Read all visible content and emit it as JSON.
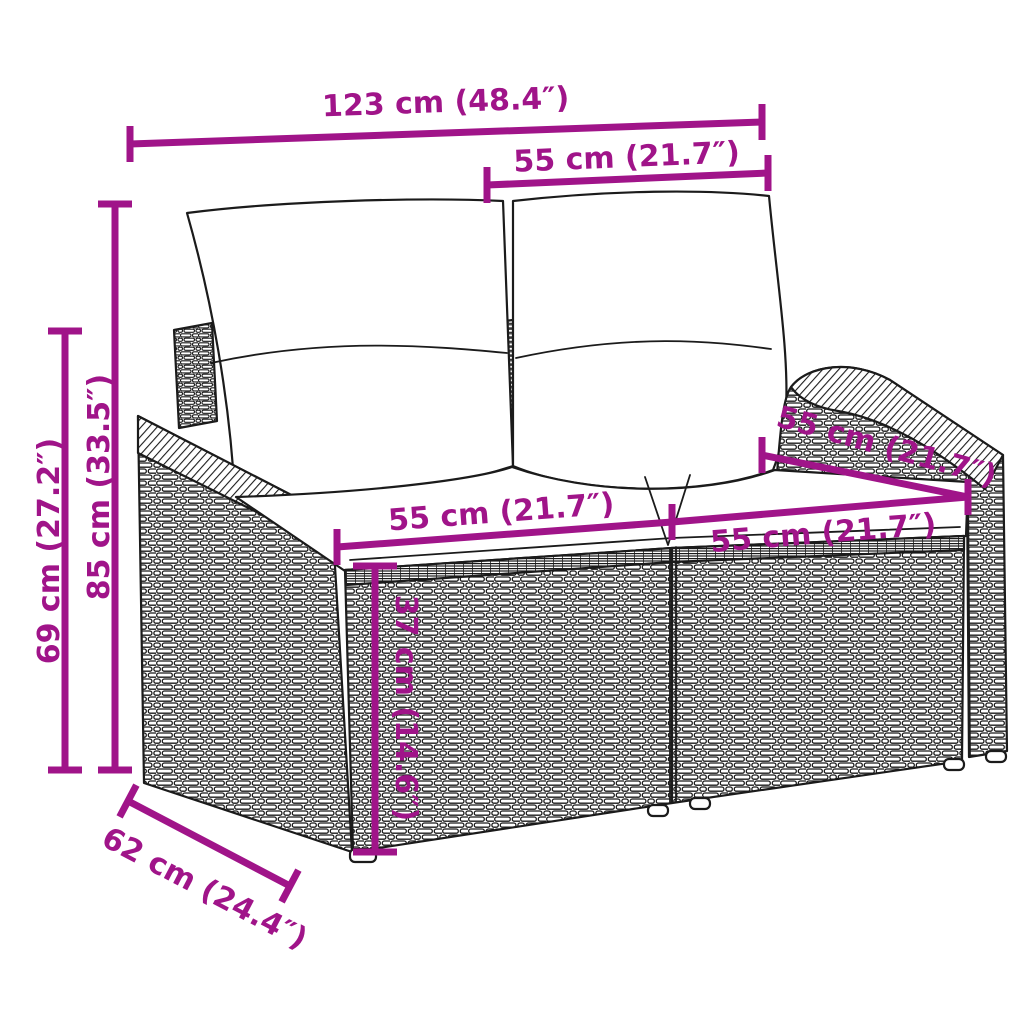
{
  "colors": {
    "accent": "#A01489",
    "line_art": "#1B1B1B",
    "cushion": "#FFFFFF",
    "background": "#FFFFFF"
  },
  "dimensions": {
    "overall_width": "123 cm (48.4″)",
    "backrest_cushion_width": "55 cm (21.7″)",
    "overall_height": "85 cm (33.5″)",
    "armrest_height": "69 cm (27.2″)",
    "seat_width_left": "55 cm (21.7″)",
    "seat_width_right": "55 cm (21.7″)",
    "seat_depth": "55 cm (21.7″)",
    "seat_height": "37 cm (14.6″)",
    "overall_depth": "62 cm (24.4″)"
  }
}
